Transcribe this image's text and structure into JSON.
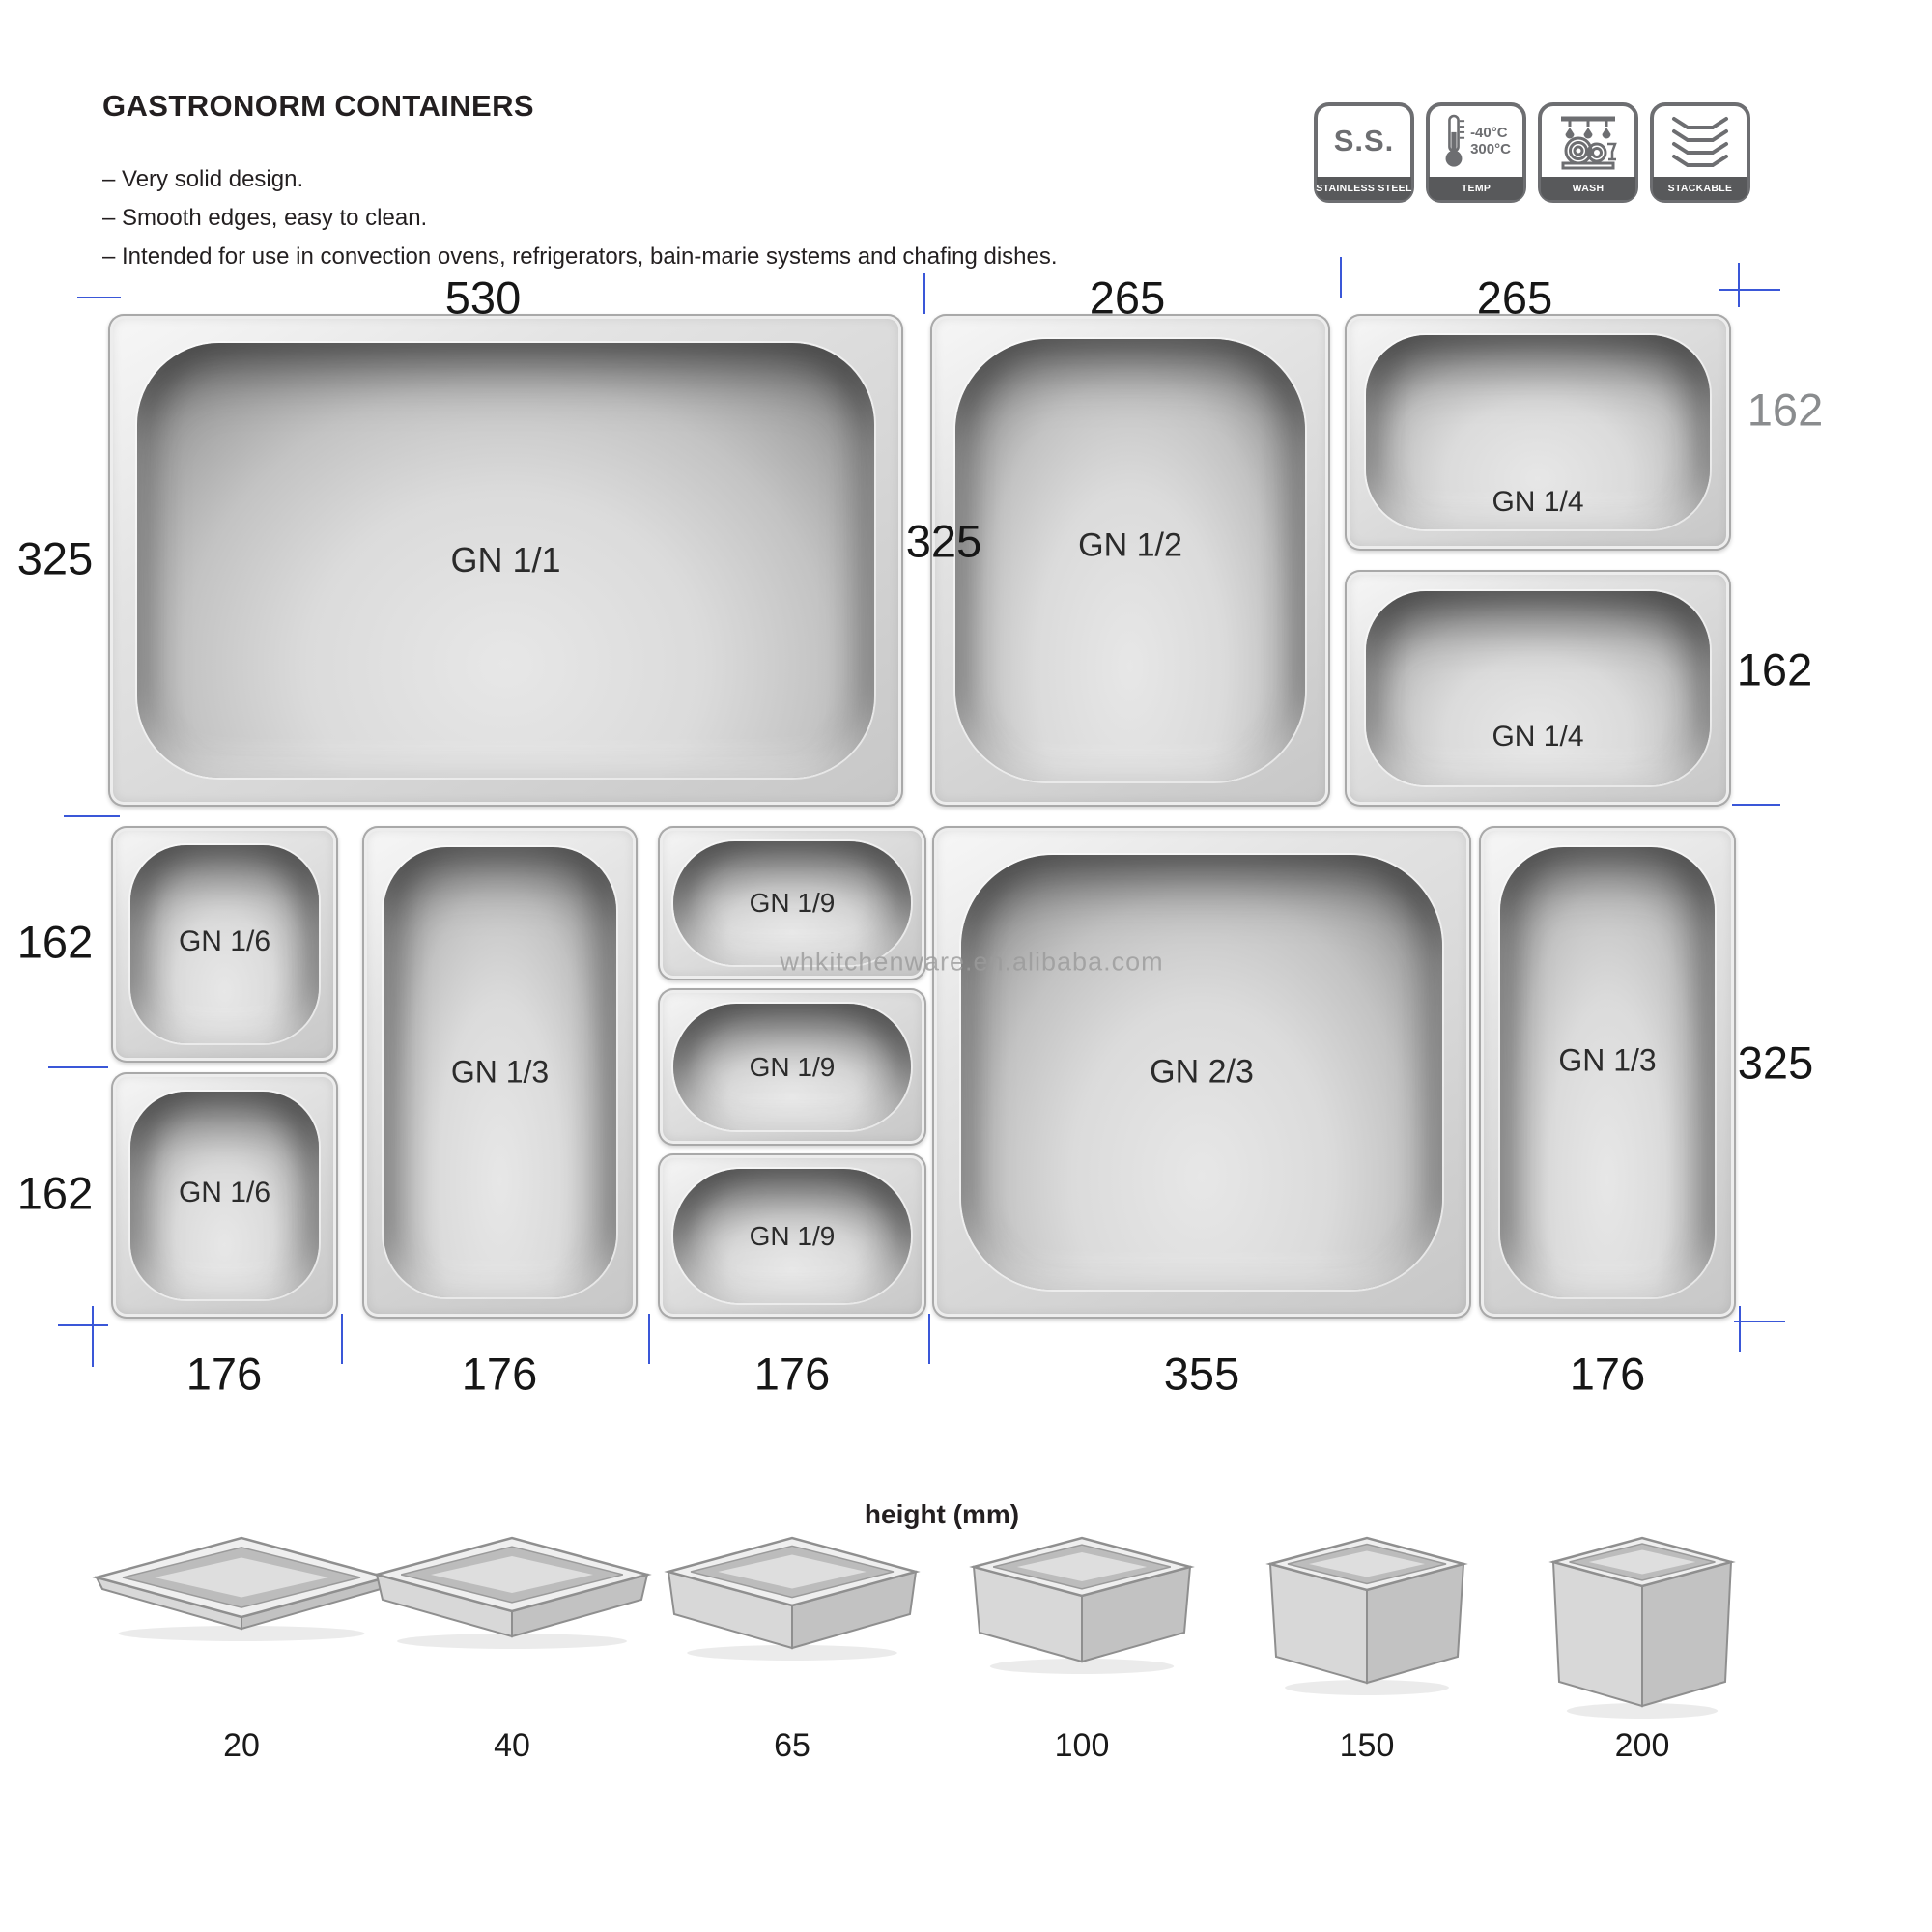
{
  "header": {
    "title": "GASTRONORM CONTAINERS",
    "bullets": [
      "– Very solid design.",
      "– Smooth edges, easy to clean.",
      "– Intended for use in convection ovens, refrigerators, bain-marie systems and chafing dishes."
    ]
  },
  "feature_badges": [
    {
      "id": "stainless",
      "icon": "ss-text-icon",
      "icon_text": "S.S.",
      "label": "STAINLESS STEEL"
    },
    {
      "id": "temp",
      "icon": "thermometer-icon",
      "temp_min": "-40°C",
      "temp_max": "300°C",
      "label": "TEMP"
    },
    {
      "id": "wash",
      "icon": "dishwasher-icon",
      "label": "WASH"
    },
    {
      "id": "stackable",
      "icon": "stacked-pans-icon",
      "label": "STACKABLE"
    }
  ],
  "diagram": {
    "watermark": "whkitchenware.en.alibaba.com",
    "pans": [
      {
        "id": "gn11",
        "label": "GN 1/1"
      },
      {
        "id": "gn12",
        "label": "GN 1/2"
      },
      {
        "id": "gn14a",
        "label": "GN 1/4"
      },
      {
        "id": "gn14b",
        "label": "GN 1/4"
      },
      {
        "id": "gn16a",
        "label": "GN 1/6"
      },
      {
        "id": "gn16b",
        "label": "GN 1/6"
      },
      {
        "id": "gn13a",
        "label": "GN 1/3"
      },
      {
        "id": "gn19a",
        "label": "GN 1/9"
      },
      {
        "id": "gn19b",
        "label": "GN 1/9"
      },
      {
        "id": "gn19c",
        "label": "GN 1/9"
      },
      {
        "id": "gn23",
        "label": "GN 2/3"
      },
      {
        "id": "gn13b",
        "label": "GN 1/3"
      }
    ],
    "dimension_labels": [
      {
        "id": "d530",
        "text": "530"
      },
      {
        "id": "d265a",
        "text": "265"
      },
      {
        "id": "d265b",
        "text": "265"
      },
      {
        "id": "d325a",
        "text": "325"
      },
      {
        "id": "d325b",
        "text": "325"
      },
      {
        "id": "d162a",
        "text": "162",
        "gray": true
      },
      {
        "id": "d162b",
        "text": "162"
      },
      {
        "id": "d162c",
        "text": "162"
      },
      {
        "id": "d162d",
        "text": "162"
      },
      {
        "id": "d325c",
        "text": "325"
      },
      {
        "id": "d176a",
        "text": "176"
      },
      {
        "id": "d176b",
        "text": "176"
      },
      {
        "id": "d176c",
        "text": "176"
      },
      {
        "id": "d355",
        "text": "355"
      },
      {
        "id": "d176d",
        "text": "176"
      }
    ]
  },
  "height_section": {
    "title": "height (mm)",
    "heights": [
      "20",
      "40",
      "65",
      "100",
      "150",
      "200"
    ]
  },
  "colors": {
    "tick_blue": "#3a57d8",
    "badge_gray": "#6d6e71",
    "badge_bar_gray": "#58595b",
    "dimension_text": "#161616",
    "dimension_text_gray": "#8a8c8e"
  }
}
